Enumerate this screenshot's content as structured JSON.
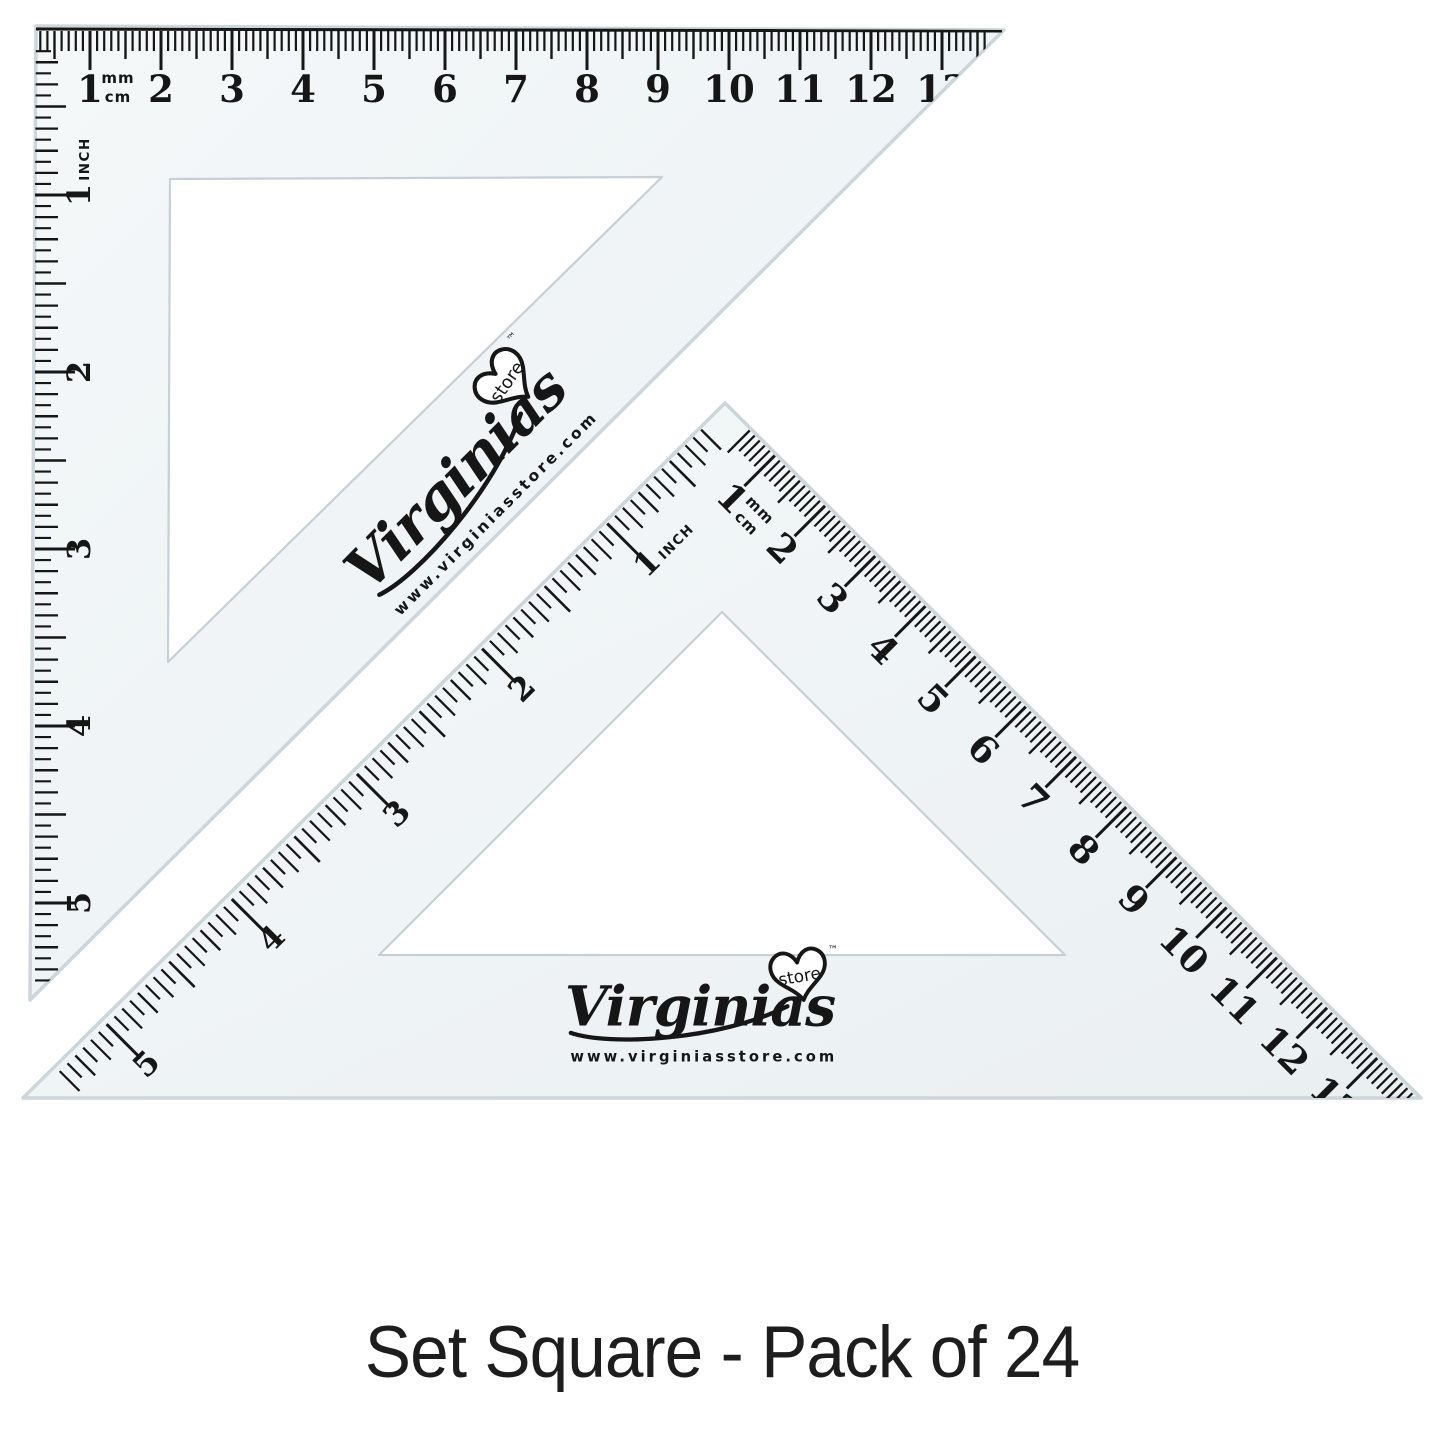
{
  "caption": {
    "text": "Set Square - Pack of 24"
  },
  "branding": {
    "brand_script": "Virginias",
    "heart_badge": "store",
    "trademark": "™",
    "website": "www.virginiasstore.com"
  },
  "scales": {
    "cm": {
      "labels": [
        "1",
        "2",
        "3",
        "4",
        "5",
        "6",
        "7",
        "8",
        "9",
        "10",
        "11",
        "12",
        "13"
      ],
      "unit_top": "mm",
      "unit_bottom": "cm"
    },
    "inch": {
      "labels": [
        "1",
        "2",
        "3",
        "4",
        "5"
      ],
      "unit": "INCH"
    }
  },
  "colors": {
    "background": "#ffffff",
    "plastic_light": "#f4f8f9",
    "plastic_dark": "#eaeff2",
    "plastic_edge": "#ccd6db",
    "hole_edge": "#c6d0d6",
    "ink": "#161616",
    "caption_ink": "#1d1d1d"
  }
}
